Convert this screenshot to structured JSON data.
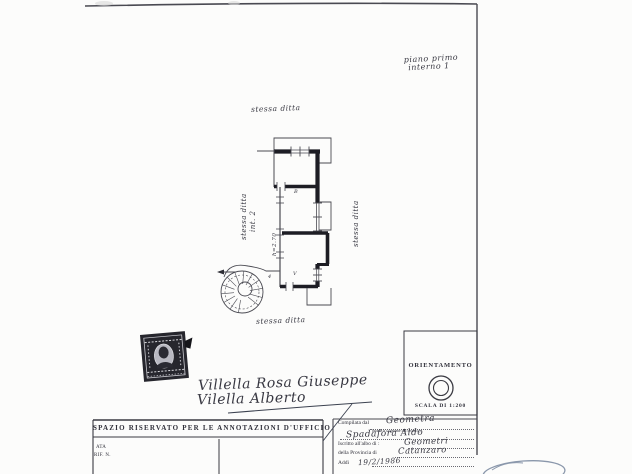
{
  "page_note": {
    "line1": "piano primo",
    "line2": "interno 1"
  },
  "plan": {
    "label_top": "stessa ditta",
    "label_left_line1": "stessa ditta",
    "label_left_line2": "int. 2",
    "label_right": "stessa ditta",
    "label_bottom": "stessa ditta",
    "height_note": "h=2.70",
    "room_b": "B",
    "room_v": "V",
    "door_num": "4"
  },
  "orientation": {
    "title": "ORIENTAMENTO",
    "scale": "SCALA DI 1:200"
  },
  "annotations_box": {
    "header": "SPAZIO RISERVATO PER LE ANNOTAZIONI D'UFFICIO",
    "left_line1": "ATA",
    "left_line2": "RIF. N."
  },
  "form": {
    "compiled_by_label": "Compilata dal",
    "compiled_by_value": "Geometra",
    "compiled_by_subnote": "(nome e cognome del tecnico)",
    "signature": "Spadafora Aldo",
    "register_label": "Iscritto all'albo di :",
    "register_value": "Geometri",
    "province_label": "della Provincia di",
    "province_value": "Catanzaro",
    "date_label": "Addì",
    "date_value": "19/2/1986"
  },
  "signatures": {
    "line1": "Villella Rosa Giuseppe",
    "line2": "Vilella Alberto"
  },
  "colors": {
    "ink": "#2e2e35",
    "paper": "#fcfcfb",
    "scribble_blue": "#8a97ab"
  }
}
